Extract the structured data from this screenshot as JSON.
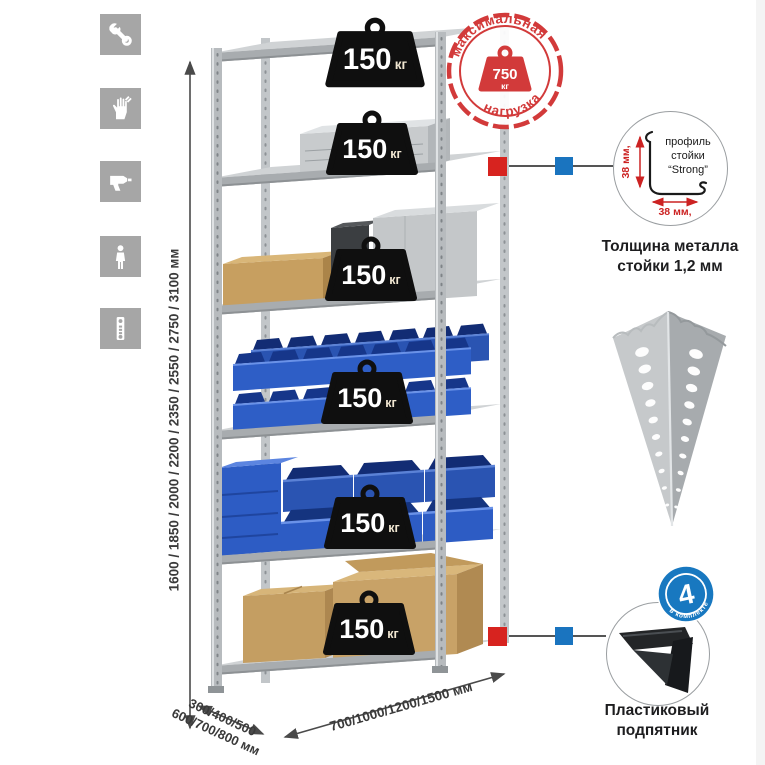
{
  "page": {
    "bg": "#ffffff"
  },
  "sidebar": {
    "tile_color": "#a6a6a6",
    "icons": [
      "wrench",
      "gloves",
      "drill",
      "person",
      "level"
    ]
  },
  "rack": {
    "shelf_count": 6,
    "shelf_load": {
      "value": "150",
      "unit": "кг"
    }
  },
  "max_load_badge": {
    "arc_top": "максимальная",
    "arc_bottom": "нагрузка",
    "value": "750",
    "unit": "кг",
    "color": "#d23a3a"
  },
  "dimensions": {
    "height_label": "1600 / 1850 / 2000 / 2200 / 2350 / 2550 / 2750 / 3100 мм",
    "depth_line1": "300/400/500",
    "depth_line2": "600/700/800 мм",
    "width_label": "700/1000/1200/1500 мм"
  },
  "profile_detail": {
    "label_line1": "профиль",
    "label_line2": "стойки",
    "label_line3": "“Strong”",
    "dim_vertical": "38 мм,",
    "dim_horizontal": "38 мм,",
    "caption_line1": "Толщина металла",
    "caption_line2": "стойки 1,2 мм"
  },
  "foot_detail": {
    "badge_value": "4",
    "badge_arc": "в комплекте",
    "caption_line1": "Пластиковый",
    "caption_line2": "подпятник"
  },
  "markers": {
    "red": "#d7231f",
    "blue": "#1a74bf"
  }
}
